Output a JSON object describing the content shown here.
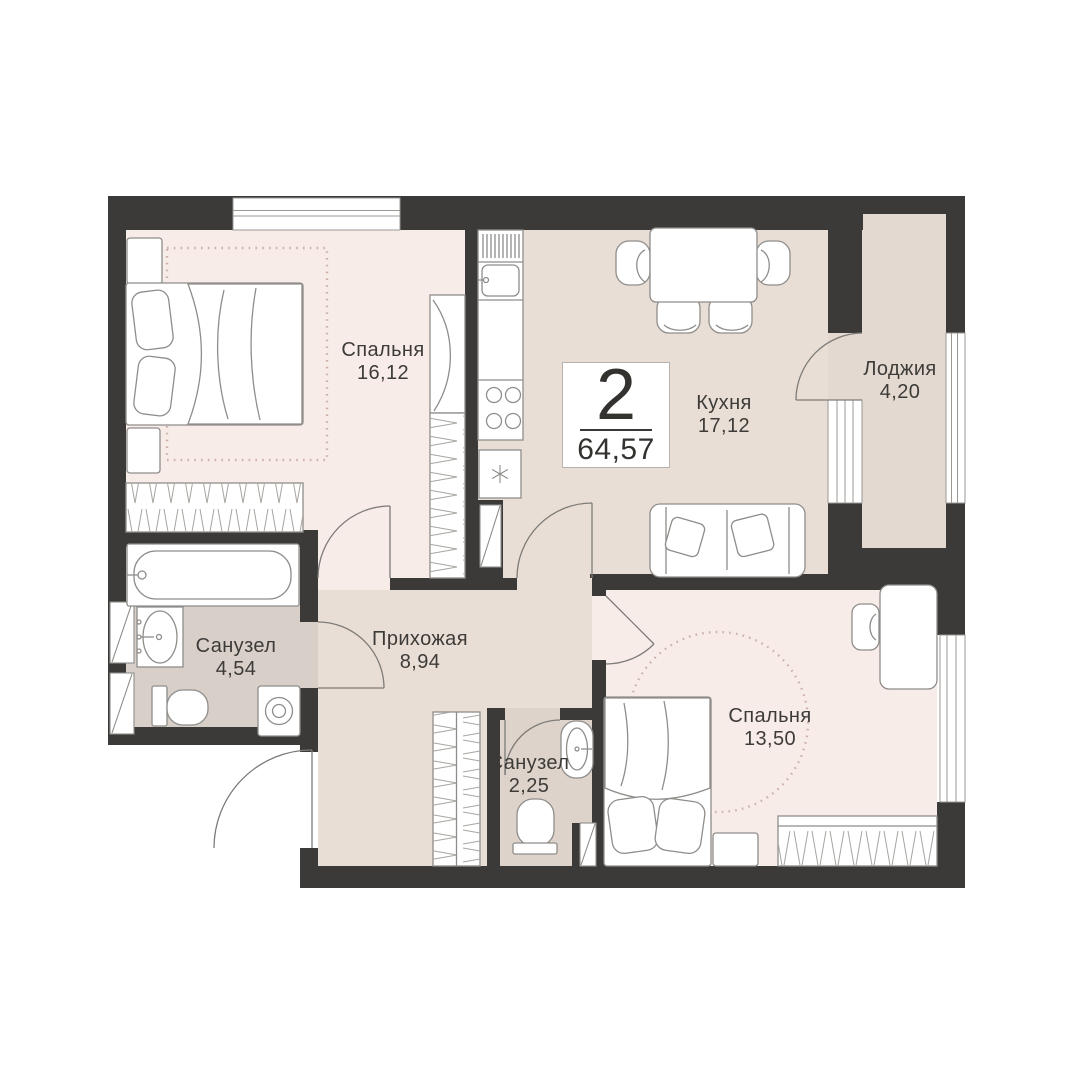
{
  "badge": {
    "rooms_count": "2",
    "total_area": "64,57"
  },
  "rooms": [
    {
      "name": "Спальня",
      "area": "16,12"
    },
    {
      "name": "Кухня",
      "area": "17,12"
    },
    {
      "name": "Лоджия",
      "area": "4,20"
    },
    {
      "name": "Санузел",
      "area": "4,54"
    },
    {
      "name": "Прихожая",
      "area": "8,94"
    },
    {
      "name": "Санузел",
      "area": "2,25"
    },
    {
      "name": "Спальня",
      "area": "13,50"
    }
  ],
  "colors": {
    "wall": "#3b3a38",
    "bedroom_floor": "#f8ece9",
    "kitchen_floor": "#e9ded6",
    "loggia_floor": "#e3d9d0",
    "bathroom1_floor": "#d8cfc8",
    "bathroom2_floor": "#ddd3cb",
    "furniture_stroke": "#8f8d8a",
    "rug_dots": "#cbb2a9",
    "text": "#3d3b38",
    "badge_border": "#b5b1ad"
  }
}
